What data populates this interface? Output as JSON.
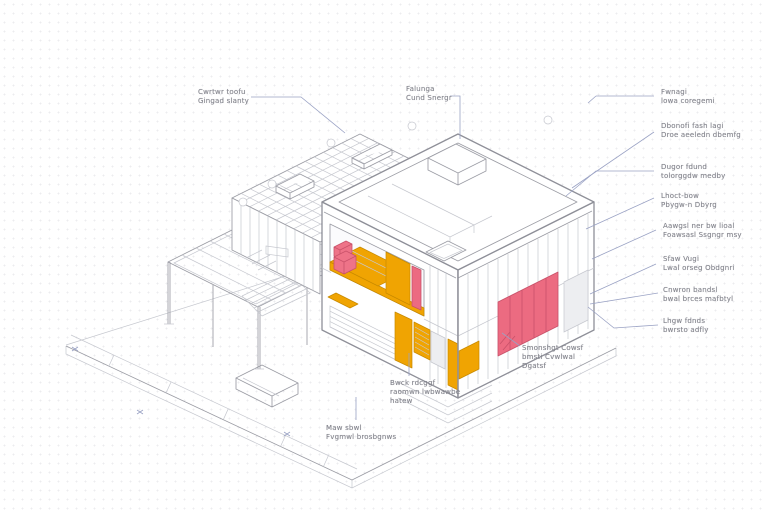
{
  "colors": {
    "accent_orange": "#F0A402",
    "accent_pink": "#EC6B81",
    "chair_pink": "#EE7388",
    "pink_stroke": "#C9526A",
    "orange_stroke": "#C88A00",
    "line": "#8F9099",
    "line_light": "#C6C8CF",
    "leader": "#9AA2C4",
    "label_text": "#85868E",
    "table_wood": "#D8B894"
  },
  "labels": {
    "tl": {
      "lines": [
        "Cwrtwr toofu",
        "Gingad slanty"
      ]
    },
    "tm": {
      "lines": [
        "Falunga",
        "Cund Snergr"
      ]
    },
    "r1": {
      "lines": [
        "Fwnagi",
        "lowa coregemi"
      ]
    },
    "r2": {
      "lines": [
        "Dbonofi fash lagi",
        "Droe aeeledn dbemfg"
      ]
    },
    "r3": {
      "lines": [
        "Dugor fdund",
        "tolorggdw medby"
      ]
    },
    "r4": {
      "lines": [
        "Lhoct-bow",
        "Pbygw-n Dbyrg"
      ]
    },
    "r5": {
      "lines": [
        "Aawgsl ner bw lioal",
        "Foawsasl Ssgngr msy"
      ]
    },
    "r6": {
      "lines": [
        "Sfaw Vugi",
        "Lwal orseg Obdgnri"
      ]
    },
    "r7": {
      "lines": [
        "Cnwron bandsl",
        "bwal brces mafbtyl"
      ]
    },
    "r8": {
      "lines": [
        "Lhgw fdnds",
        "bwrsto adfly"
      ]
    },
    "b1": {
      "lines": [
        "Smonshgt Cowsf",
        "bmsti Cvwlwal",
        "Dgatsf"
      ]
    },
    "b2": {
      "lines": [
        "Bwck rdcggf",
        "raomwn lwbwawbe",
        "hatew"
      ]
    },
    "b3": {
      "lines": [
        "Maw sbwl",
        "Fvgmwl brosbgnws"
      ]
    }
  }
}
